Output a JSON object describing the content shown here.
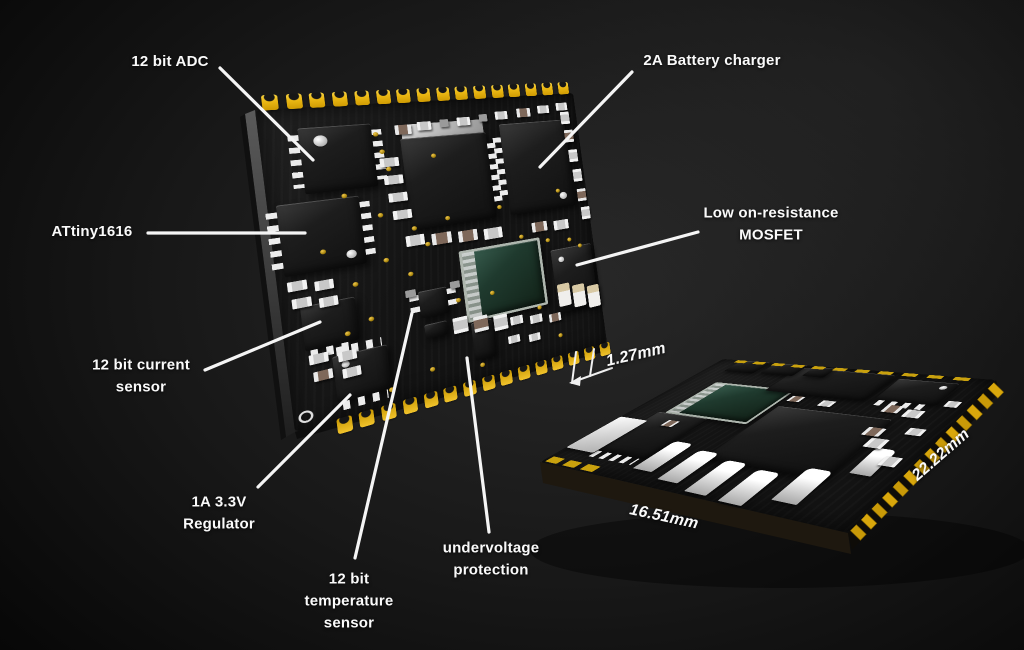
{
  "annotations": {
    "adc": {
      "label": "12 bit ADC"
    },
    "battery_charger": {
      "label": "2A Battery charger"
    },
    "mcu": {
      "label": "ATtiny1616"
    },
    "mosfet": {
      "label": "Low on-resistance\nMOSFET"
    },
    "current_sensor": {
      "label": "12 bit current\nsensor"
    },
    "regulator": {
      "label": "1A 3.3V\nRegulator"
    },
    "temp_sensor": {
      "label": "12 bit\ntemperature\nsensor"
    },
    "undervoltage": {
      "label": "undervoltage\nprotection"
    }
  },
  "dimensions": {
    "pin_pitch": "1.27mm",
    "board_width": "16.51mm",
    "board_depth": "22.22mm"
  },
  "colors": {
    "background": "#000000",
    "pcb_black": "#131313",
    "castellation_yellow": "#eab713",
    "label_text": "#fafafa",
    "die_teal": "#23402f"
  }
}
